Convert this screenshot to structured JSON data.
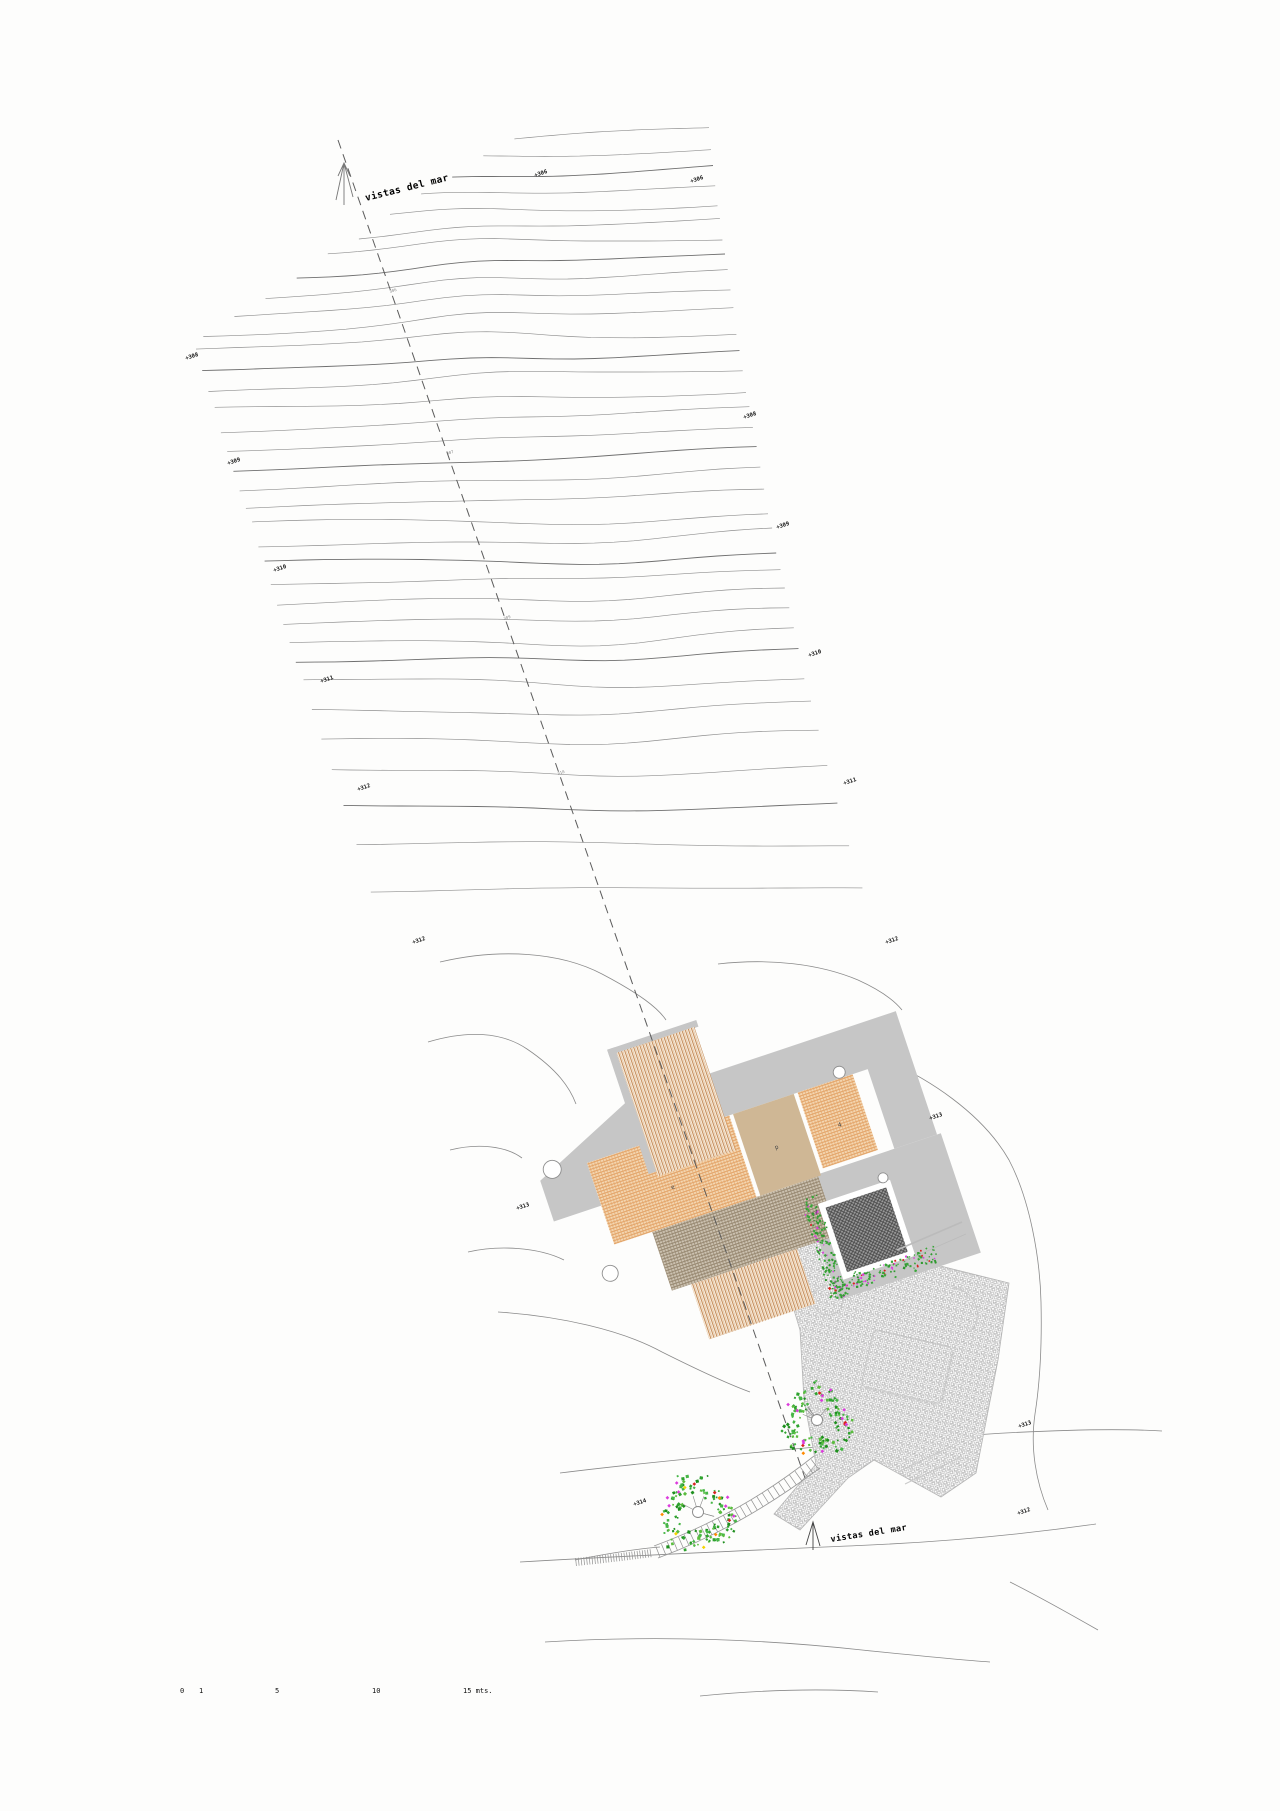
{
  "page": {
    "width": 1280,
    "height": 1811,
    "background": "#fdfdfc",
    "drawing_type": "architectural site plan with topographic contours"
  },
  "labels": {
    "view_top": "vistas del mar",
    "view_bottom": "vistas del mar"
  },
  "elevation_labels": [
    {
      "text": "+306",
      "x": 535,
      "y": 177
    },
    {
      "text": "+306",
      "x": 691,
      "y": 183
    },
    {
      "text": "+308",
      "x": 186,
      "y": 360
    },
    {
      "text": "+308",
      "x": 744,
      "y": 419
    },
    {
      "text": "+309",
      "x": 228,
      "y": 465
    },
    {
      "text": "+309",
      "x": 777,
      "y": 529
    },
    {
      "text": "+310",
      "x": 274,
      "y": 572
    },
    {
      "text": "+310",
      "x": 809,
      "y": 657
    },
    {
      "text": "+311",
      "x": 321,
      "y": 683
    },
    {
      "text": "+311",
      "x": 844,
      "y": 785
    },
    {
      "text": "+312",
      "x": 358,
      "y": 791
    },
    {
      "text": "+312",
      "x": 886,
      "y": 944
    },
    {
      "text": "+312",
      "x": 413,
      "y": 944
    },
    {
      "text": "+313",
      "x": 517,
      "y": 1210
    },
    {
      "text": "+313",
      "x": 930,
      "y": 1120
    },
    {
      "text": "+313",
      "x": 1019,
      "y": 1428
    },
    {
      "text": "+314",
      "x": 634,
      "y": 1506
    },
    {
      "text": "+312",
      "x": 1018,
      "y": 1515
    }
  ],
  "section_marks": [
    {
      "text": "306",
      "x": 390,
      "y": 293
    },
    {
      "text": "307",
      "x": 447,
      "y": 455
    },
    {
      "text": "309",
      "x": 504,
      "y": 620
    },
    {
      "text": "310",
      "x": 558,
      "y": 775
    }
  ],
  "room_labels": [
    {
      "text": "e",
      "u": 72,
      "v": 52
    },
    {
      "text": "p",
      "u": 183,
      "v": 47
    },
    {
      "text": "4",
      "u": 250,
      "v": 46
    },
    {
      "text": "7",
      "u": 200,
      "v": 122
    }
  ],
  "scale_bar": {
    "y": 1693,
    "ticks": [
      {
        "label": "0",
        "x": 180
      },
      {
        "label": "1",
        "x": 199
      },
      {
        "label": "5",
        "x": 275
      },
      {
        "label": "10",
        "x": 372
      },
      {
        "label": "15 mts.",
        "x": 463
      }
    ]
  },
  "trees": [
    {
      "cx": 817,
      "cy": 1420,
      "r": 34
    },
    {
      "cx": 698,
      "cy": 1512,
      "r": 37
    }
  ],
  "building": {
    "origin_x": 587,
    "origin_y": 1163,
    "rotation_deg": -18.5
  },
  "contours": {
    "upper_line_count": 35,
    "lower_line_count": 14,
    "line_color": "#8f8f8f",
    "index_line_color": "#6f6f6f"
  },
  "colors": {
    "contour": "#8f8f8f",
    "section_line": "#5c5c5c",
    "terrace_gray": "#c6c6c6",
    "wing_hatch": "#bf8049",
    "room_orange": "#dd9757",
    "room_tan": "#cfb795",
    "band_brown": "#8b7b63",
    "pool_dark": "#4a4a4a",
    "paving_gray": "#9b9b9b",
    "vegetation_green": "#3aa63a",
    "flower_magenta": "#dc3cdc",
    "flower_red": "#d82420",
    "flower_orange": "#ff8a00",
    "flower_yellow": "#f5d400",
    "text_black": "#111111"
  }
}
